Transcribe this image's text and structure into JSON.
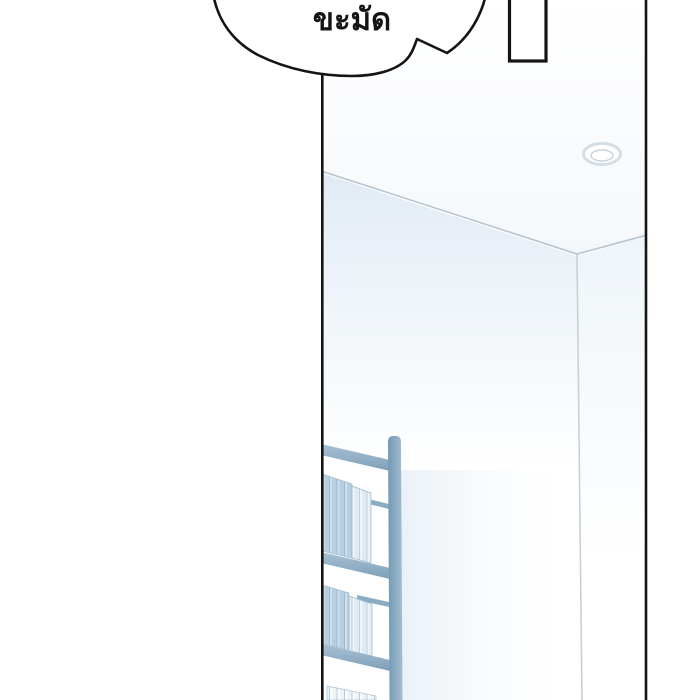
{
  "speech_bubble": {
    "text": "ขะมัด"
  },
  "colors": {
    "ink": "#141414",
    "bubble_fill": "#ffffff",
    "door_fill": "#ffffff",
    "ceiling_line": "#b8c4d0",
    "corner_line": "#c6d1db",
    "light_ring": "#d5dee6",
    "light_inner": "#c9d4dd",
    "rail": "#8badc4",
    "post_cap": "#8fb0c6",
    "binder_outline": "#9cb9ce",
    "binder_row3_outline": "#a9c0d2"
  }
}
